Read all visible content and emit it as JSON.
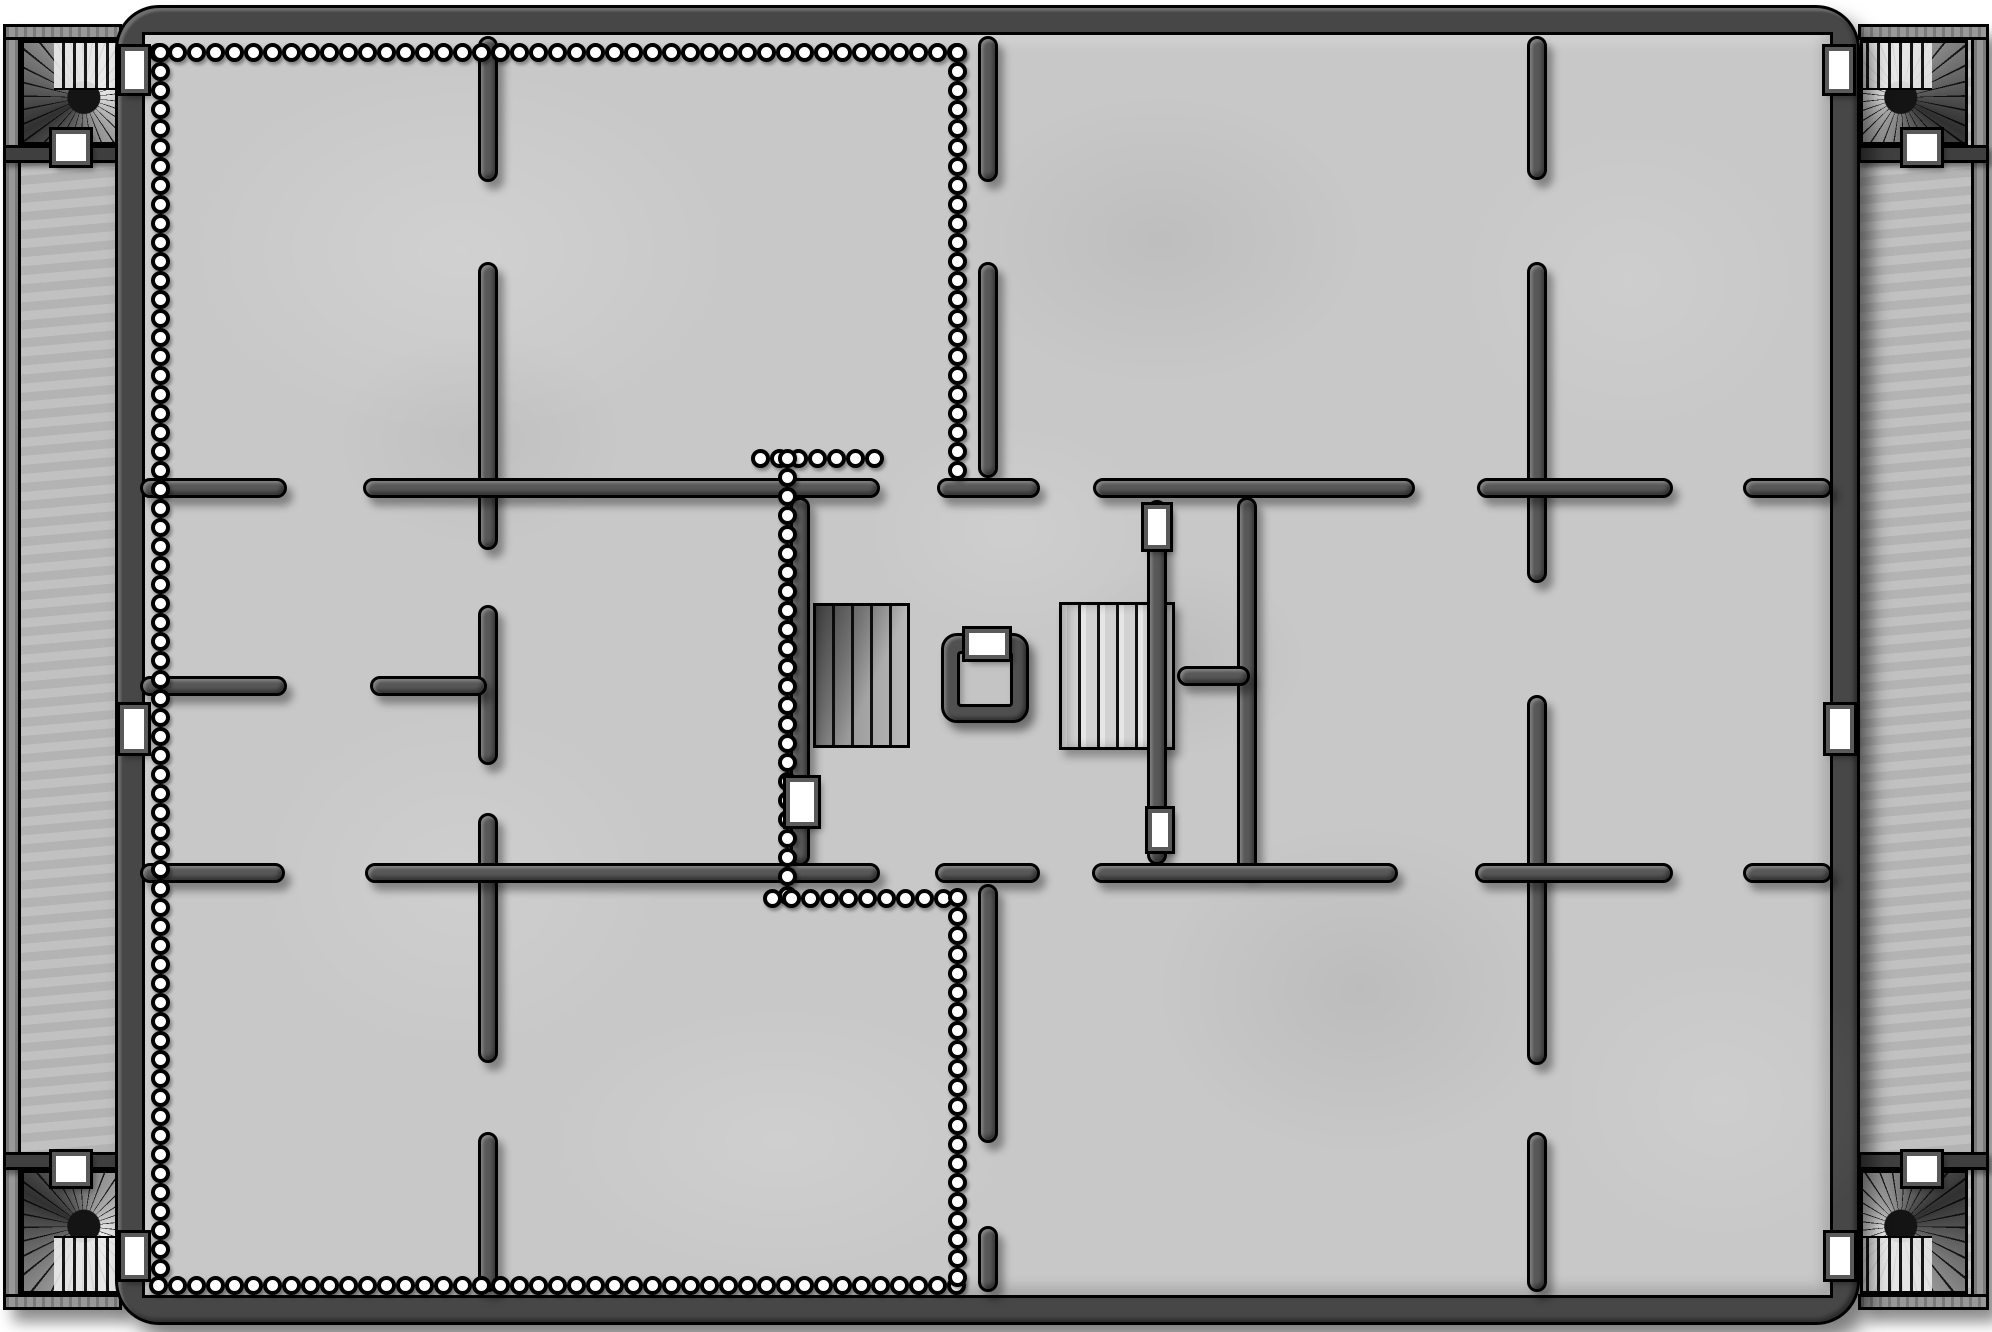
{
  "canvas": {
    "width": 1992,
    "height": 1332,
    "background": "#ffffff"
  },
  "palette": {
    "floor": "#c8c8c8",
    "corridor_floor": "#bdbdbd",
    "border_fill": "#474747",
    "wall_fill": "#585858",
    "outline": "#000000",
    "door_fill": "#ffffff",
    "door_frame": "#5a5a5a",
    "pillar_fill": "#ffffff",
    "stairs_light": "#dcdcdc",
    "stairs_dark": "#9a9a9a",
    "well_ring": "#505050",
    "well_floor": "#c4c4c4",
    "wing_wall": "#8f8f8f",
    "divider": "#3f3f3f"
  },
  "main_border": {
    "x": 115,
    "y": 5,
    "w": 1745,
    "h": 1320,
    "band": 30
  },
  "floor_rect": {
    "x": 145,
    "y": 35,
    "w": 1685,
    "h": 1260
  },
  "wings": [
    {
      "name": "left-wing",
      "floor": {
        "x": 3,
        "y": 24,
        "w": 119,
        "h": 1286
      },
      "outer_wall": {
        "x": 3,
        "y": 24,
        "w": 18,
        "h": 1286
      },
      "top_wall": {
        "x": 3,
        "y": 24,
        "w": 119,
        "h": 16
      },
      "bottom_wall": {
        "x": 3,
        "y": 1294,
        "w": 119,
        "h": 16
      },
      "dividers": [
        {
          "x": 3,
          "y": 145,
          "w": 119,
          "h": 18
        },
        {
          "x": 3,
          "y": 1152,
          "w": 119,
          "h": 18
        }
      ]
    },
    {
      "name": "right-wing",
      "floor": {
        "x": 1858,
        "y": 24,
        "w": 131,
        "h": 1286
      },
      "outer_wall": {
        "x": 1971,
        "y": 24,
        "w": 18,
        "h": 1286
      },
      "top_wall": {
        "x": 1858,
        "y": 24,
        "w": 131,
        "h": 16
      },
      "bottom_wall": {
        "x": 1858,
        "y": 1294,
        "w": 131,
        "h": 16
      },
      "dividers": [
        {
          "x": 1858,
          "y": 145,
          "w": 131,
          "h": 18
        },
        {
          "x": 1858,
          "y": 1152,
          "w": 131,
          "h": 18
        }
      ]
    }
  ],
  "spiral_staircases": [
    {
      "name": "spiral-staircase-top-left",
      "x": 21,
      "y": 40,
      "w": 101,
      "h": 105,
      "flip": "none"
    },
    {
      "name": "spiral-staircase-top-right",
      "x": 1860,
      "y": 40,
      "w": 108,
      "h": 105,
      "flip": "x"
    },
    {
      "name": "spiral-staircase-bottom-left",
      "x": 21,
      "y": 1170,
      "w": 101,
      "h": 124,
      "flip": "y"
    },
    {
      "name": "spiral-staircase-bottom-right",
      "x": 1860,
      "y": 1170,
      "w": 108,
      "h": 124,
      "flip": "xy"
    }
  ],
  "walls": [
    {
      "x": 478,
      "y": 36,
      "w": 20,
      "h": 146
    },
    {
      "x": 478,
      "y": 262,
      "w": 20,
      "h": 288
    },
    {
      "x": 478,
      "y": 605,
      "w": 20,
      "h": 160
    },
    {
      "x": 478,
      "y": 813,
      "w": 20,
      "h": 250
    },
    {
      "x": 478,
      "y": 1132,
      "w": 20,
      "h": 160
    },
    {
      "x": 978,
      "y": 36,
      "w": 20,
      "h": 146
    },
    {
      "x": 978,
      "y": 262,
      "w": 20,
      "h": 216
    },
    {
      "x": 978,
      "y": 884,
      "w": 20,
      "h": 259
    },
    {
      "x": 978,
      "y": 1226,
      "w": 20,
      "h": 66
    },
    {
      "x": 1527,
      "y": 36,
      "w": 20,
      "h": 144
    },
    {
      "x": 1527,
      "y": 262,
      "w": 20,
      "h": 321
    },
    {
      "x": 1527,
      "y": 695,
      "w": 20,
      "h": 370
    },
    {
      "x": 1527,
      "y": 1132,
      "w": 20,
      "h": 160
    },
    {
      "x": 1237,
      "y": 497,
      "w": 20,
      "h": 377
    },
    {
      "x": 1147,
      "y": 500,
      "w": 20,
      "h": 365
    },
    {
      "x": 790,
      "y": 497,
      "w": 20,
      "h": 369
    },
    {
      "x": 140,
      "y": 478,
      "w": 147,
      "h": 20
    },
    {
      "x": 363,
      "y": 478,
      "w": 517,
      "h": 20
    },
    {
      "x": 937,
      "y": 478,
      "w": 103,
      "h": 20
    },
    {
      "x": 1093,
      "y": 478,
      "w": 322,
      "h": 20
    },
    {
      "x": 1477,
      "y": 478,
      "w": 196,
      "h": 20
    },
    {
      "x": 1743,
      "y": 478,
      "w": 89,
      "h": 20
    },
    {
      "x": 1177,
      "y": 666,
      "w": 73,
      "h": 20
    },
    {
      "x": 140,
      "y": 676,
      "w": 147,
      "h": 20
    },
    {
      "x": 370,
      "y": 676,
      "w": 117,
      "h": 20
    },
    {
      "x": 140,
      "y": 863,
      "w": 145,
      "h": 20
    },
    {
      "x": 365,
      "y": 863,
      "w": 515,
      "h": 20
    },
    {
      "x": 935,
      "y": 863,
      "w": 105,
      "h": 20
    },
    {
      "x": 1092,
      "y": 863,
      "w": 306,
      "h": 20
    },
    {
      "x": 1475,
      "y": 863,
      "w": 198,
      "h": 20
    },
    {
      "x": 1743,
      "y": 863,
      "w": 89,
      "h": 20
    }
  ],
  "pillar_lines": [
    {
      "type": "h",
      "y": 52,
      "x1": 158,
      "x2": 962
    },
    {
      "type": "v",
      "x": 160,
      "y1": 52,
      "y2": 1285
    },
    {
      "type": "h",
      "y": 1285,
      "x1": 158,
      "x2": 962
    },
    {
      "type": "v",
      "x": 957,
      "y1": 52,
      "y2": 470
    },
    {
      "type": "h",
      "y": 458,
      "x1": 760,
      "x2": 892
    },
    {
      "type": "v",
      "x": 787,
      "y1": 458,
      "y2": 898
    },
    {
      "type": "h",
      "y": 898,
      "x1": 772,
      "x2": 958
    },
    {
      "type": "v",
      "x": 957,
      "y1": 897,
      "y2": 1285
    }
  ],
  "stairs": [
    {
      "name": "stairs-central-left",
      "x": 813,
      "y": 603,
      "w": 97,
      "h": 145,
      "tone": "dark"
    },
    {
      "name": "stairs-central-right",
      "x": 1059,
      "y": 602,
      "w": 116,
      "h": 148,
      "tone": "light"
    }
  ],
  "well": {
    "outer": {
      "x": 941,
      "y": 633,
      "w": 88,
      "h": 90
    },
    "inner": {
      "x": 957,
      "y": 651,
      "w": 56,
      "h": 56
    }
  },
  "doors": [
    {
      "name": "door-left-wall",
      "x": 120,
      "y": 705,
      "w": 28,
      "h": 48
    },
    {
      "name": "door-right-wall",
      "x": 1826,
      "y": 705,
      "w": 28,
      "h": 48
    },
    {
      "name": "door-top-left-stair-east",
      "x": 121,
      "y": 47,
      "w": 27,
      "h": 46
    },
    {
      "name": "door-top-left-stair-south",
      "x": 52,
      "y": 130,
      "w": 38,
      "h": 35
    },
    {
      "name": "door-top-right-stair-west",
      "x": 1825,
      "y": 47,
      "w": 28,
      "h": 46
    },
    {
      "name": "door-top-right-stair-south",
      "x": 1903,
      "y": 130,
      "w": 38,
      "h": 35
    },
    {
      "name": "door-bottom-left-stair-east",
      "x": 121,
      "y": 1233,
      "w": 27,
      "h": 46
    },
    {
      "name": "door-bottom-left-stair-north",
      "x": 52,
      "y": 1152,
      "w": 38,
      "h": 34
    },
    {
      "name": "door-bottom-right-stair-west",
      "x": 1826,
      "y": 1233,
      "w": 28,
      "h": 46
    },
    {
      "name": "door-bottom-right-stair-north",
      "x": 1903,
      "y": 1152,
      "w": 38,
      "h": 34
    },
    {
      "name": "door-above-right-stairs",
      "x": 1144,
      "y": 505,
      "w": 26,
      "h": 44
    },
    {
      "name": "door-below-right-stairs",
      "x": 1148,
      "y": 809,
      "w": 24,
      "h": 42
    },
    {
      "name": "door-colonnade",
      "x": 786,
      "y": 778,
      "w": 32,
      "h": 48
    },
    {
      "name": "door-well",
      "x": 965,
      "y": 629,
      "w": 44,
      "h": 30
    }
  ],
  "floor_patches": [
    {
      "x": 180,
      "y": 60,
      "w": 560,
      "h": 380,
      "color": "255,255,255",
      "opacity": 0.16
    },
    {
      "x": 950,
      "y": 90,
      "w": 420,
      "h": 300,
      "color": "0,0,0",
      "opacity": 0.05
    },
    {
      "x": 1450,
      "y": 120,
      "w": 360,
      "h": 320,
      "color": "255,255,255",
      "opacity": 0.1
    },
    {
      "x": 250,
      "y": 700,
      "w": 420,
      "h": 360,
      "color": "255,255,255",
      "opacity": 0.12
    },
    {
      "x": 1150,
      "y": 820,
      "w": 420,
      "h": 340,
      "color": "0,0,0",
      "opacity": 0.06
    },
    {
      "x": 540,
      "y": 1000,
      "w": 480,
      "h": 280,
      "color": "255,255,255",
      "opacity": 0.13
    },
    {
      "x": 1550,
      "y": 950,
      "w": 340,
      "h": 300,
      "color": "255,255,255",
      "opacity": 0.1
    },
    {
      "x": 860,
      "y": 420,
      "w": 300,
      "h": 220,
      "color": "255,255,255",
      "opacity": 0.12
    },
    {
      "x": 1050,
      "y": 560,
      "w": 260,
      "h": 200,
      "color": "0,0,0",
      "opacity": 0.05
    },
    {
      "x": 330,
      "y": 330,
      "w": 300,
      "h": 220,
      "color": "0,0,0",
      "opacity": 0.04
    }
  ]
}
